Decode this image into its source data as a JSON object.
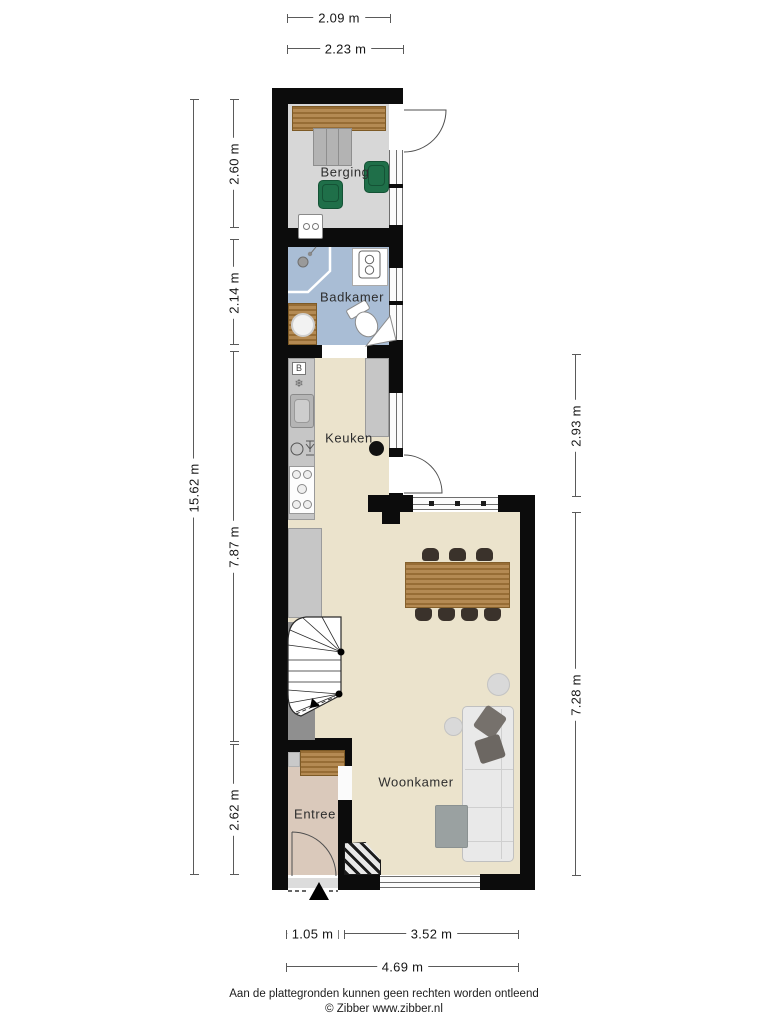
{
  "plan": {
    "rooms": {
      "berging": "Berging",
      "badkamer": "Badkamer",
      "keuken": "Keuken",
      "woonkamer": "Woonkamer",
      "entree": "Entree"
    },
    "dimensions": {
      "top_berging_width": "2.09 m",
      "top_outer_width": "2.23 m",
      "left_total_height": "15.62 m",
      "left_berging_height": "2.60 m",
      "left_badkamer_height": "2.14 m",
      "left_lower_height": "7.87 m",
      "left_entree_height": "2.62 m",
      "right_keuken_height": "2.93 m",
      "right_woonkamer_height": "7.28 m",
      "bottom_entree_width": "1.05 m",
      "bottom_woonkamer_width": "3.52 m",
      "bottom_total_width": "4.69 m"
    },
    "icons": {
      "boiler": "B",
      "ventilation": "❄"
    },
    "colors": {
      "wall": "#0c0c0c",
      "berging_floor": "#d7d7d7",
      "badkamer_floor": "#a9bdd5",
      "living_floor": "#ebe3cc",
      "entree_floor": "#dac9bb",
      "counter": "#c6c6c6",
      "wood": "#ab7d40",
      "green_seat": "#1f6f49",
      "dark_chair": "#3a322b",
      "sofa": "#e9e9e9"
    },
    "footer": {
      "disclaimer": "Aan de plattegronden kunnen geen rechten worden ontleend",
      "copyright": "© Zibber www.zibber.nl"
    }
  }
}
